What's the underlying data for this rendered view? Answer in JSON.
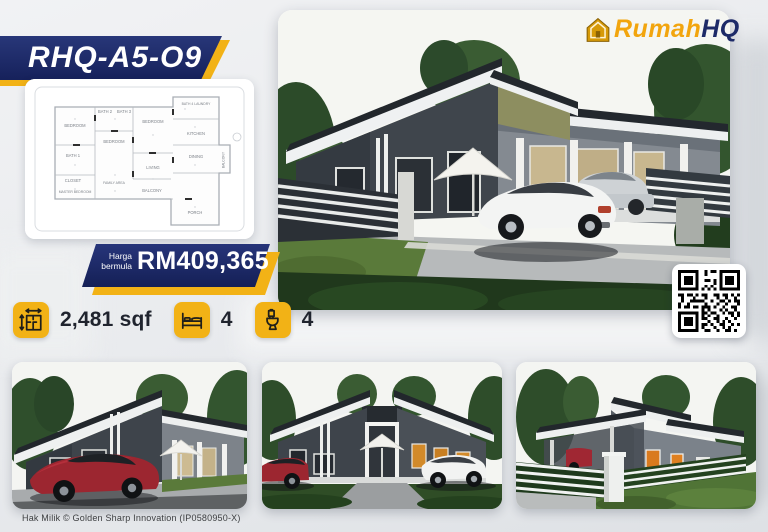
{
  "header": {
    "model_code": "RHQ-A5-O9"
  },
  "brand": {
    "part1": "Rumah",
    "part2": "HQ",
    "icon": "house-logo-icon"
  },
  "price": {
    "label_line1": "Harga",
    "label_line2": "bermula",
    "amount": "RM409,365"
  },
  "specs": {
    "items": [
      {
        "icon": "area-measure-icon",
        "value": "2,481 sqf"
      },
      {
        "icon": "bed-icon",
        "value": "4"
      },
      {
        "icon": "toilet-icon",
        "value": "4"
      }
    ]
  },
  "floor_plan": {
    "rooms": [
      "BATH 2",
      "BATH 3",
      "BEDROOM",
      "BEDROOM",
      "BEDROOM",
      "BATH 4 LAUNDRY",
      "KITCHEN",
      "DINING",
      "BALCONY",
      "LIVING",
      "BATH 1",
      "CLOSET",
      "FAMILY AREA",
      "MASTER BEDROOM",
      "BALCONY",
      "PORCH"
    ]
  },
  "footer": {
    "copyright": "Hak Milik © Golden Sharp Innovation (IP0580950-X)"
  },
  "colors": {
    "navy": "#1b2a66",
    "yellow": "#f2b216",
    "brand_gold": "#f2a50e"
  }
}
